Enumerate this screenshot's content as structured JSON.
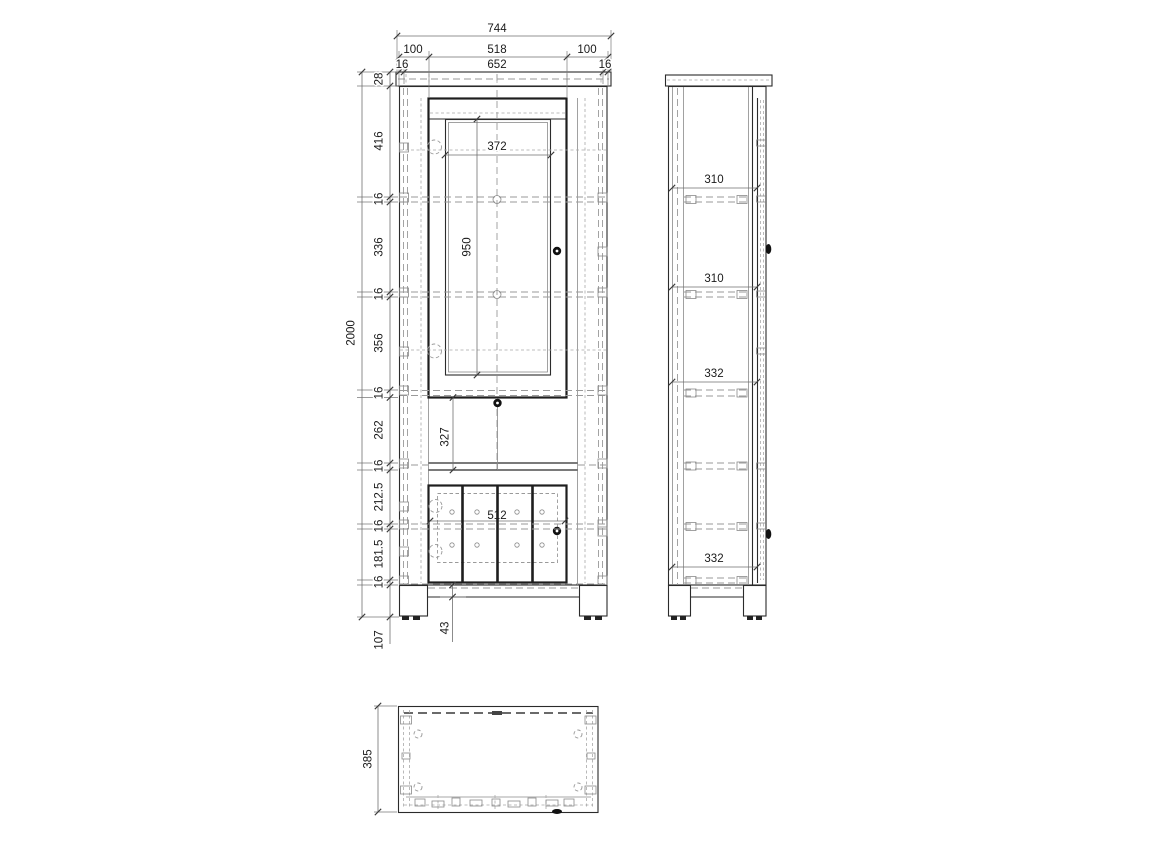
{
  "front_view": {
    "top_dims": {
      "overall": "744",
      "mid": [
        "100",
        "518",
        "100"
      ],
      "inner": [
        "16",
        "652",
        "16"
      ]
    },
    "left_dims": {
      "overall": "2000",
      "chain": [
        "28",
        "416",
        "16",
        "336",
        "16",
        "356",
        "16",
        "262",
        "16",
        "212.5",
        "16",
        "181.5",
        "16"
      ],
      "plinth": "107"
    },
    "inner_dims": {
      "glass_width": "372",
      "door_height": "950",
      "shelf_space": "327",
      "lower_doors_width": "512",
      "base_rail": "43"
    }
  },
  "side_view": {
    "shelf_gaps": [
      "310",
      "310",
      "332",
      "332"
    ]
  },
  "top_view": {
    "depth": "385"
  },
  "colors": {
    "line": "#2b2b2b",
    "hidden_line": "#9a9a9a",
    "dimension_line": "#707070",
    "text": "#1a1a1a",
    "background": "#ffffff"
  }
}
